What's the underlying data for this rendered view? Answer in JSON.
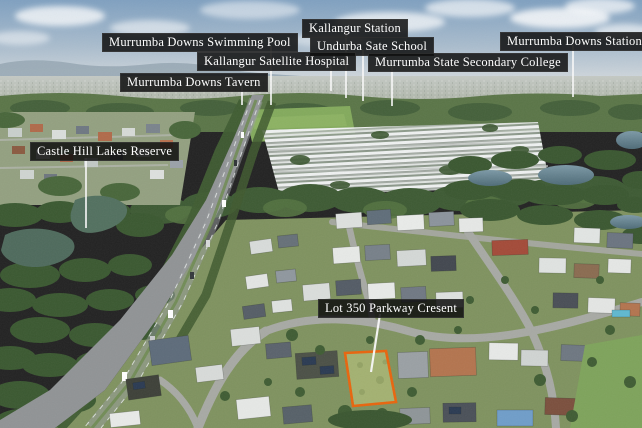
{
  "photo": {
    "kind": "aerial-drone-photo",
    "label_background": "#0e0e0e",
    "label_text_color": "#ffffff",
    "leader_line_color": "#fafafa",
    "lot_outline_color": "#e8650d"
  },
  "labels": {
    "swimming_pool": "Murrumba Downs Swimming Pool",
    "kallangur_station": "Kallangur Station",
    "undurba_school": "Undurba Sate School",
    "satellite_hospital": "Kallangur Satellite Hospital",
    "secondary_college": "Murrumba State Secondary College",
    "downs_station": "Murrumba Downs Station",
    "tavern": "Murrumba Downs Tavern",
    "castle_hill_reserve": "Castle Hill Lakes Reserve",
    "lot": "Lot 350 Parkway Cresent"
  }
}
